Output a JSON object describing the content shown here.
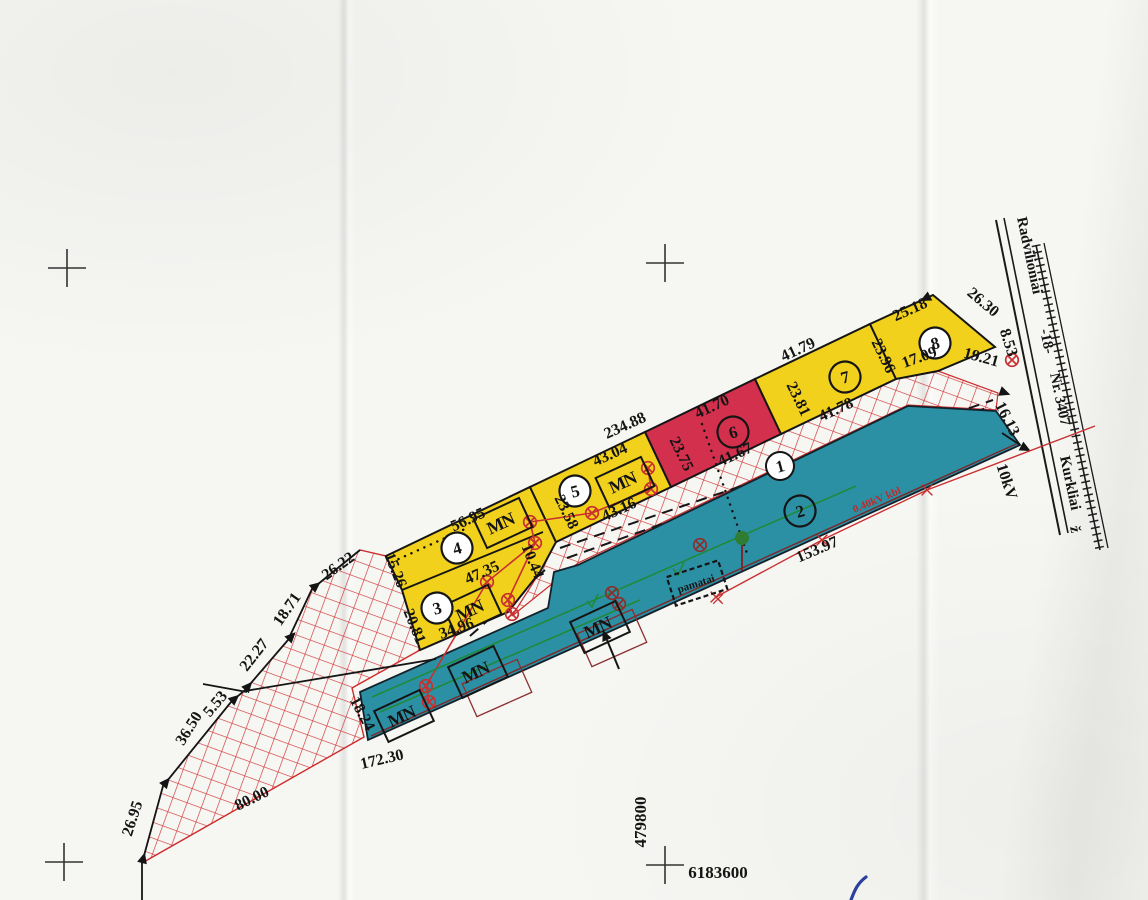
{
  "map": {
    "road": {
      "from": "Radvilioniai",
      "code": "-18-",
      "number": "Nr. 3407",
      "to": "Kurkliai",
      "suffix": "ž"
    },
    "grid": {
      "easting": "479800",
      "northing": "6183600"
    },
    "power": {
      "hv_line": "10kV",
      "lv_cable": "0.40kV kbl"
    },
    "marker_label": "MN",
    "foundation_label": "pamatai",
    "band_total": "234.88",
    "parcels": {
      "p1": {
        "number": "1"
      },
      "p2": {
        "number": "2",
        "south": "153.97",
        "east": "16.13"
      },
      "p3": {
        "number": "3",
        "north": "47.35",
        "south": "34.96",
        "west": "20.81"
      },
      "p4": {
        "number": "4",
        "north": "56.95",
        "west": "15.26",
        "east": "10.44"
      },
      "p5": {
        "number": "5",
        "north": "43.04",
        "west": "23.58",
        "power_span": "43.16"
      },
      "p6": {
        "number": "6",
        "north": "41.70",
        "south": "41.67",
        "west": "23.75",
        "east": "23.81"
      },
      "p7": {
        "number": "7",
        "north": "41.79",
        "south": "41.78",
        "east": "23.96"
      },
      "p8": {
        "number": "8",
        "north": "25.18",
        "south": "17.09",
        "east": "26.30"
      }
    },
    "east_edge": {
      "upper": "8.53",
      "lower": "19.21"
    },
    "west_boundary": {
      "seg1": "26.22",
      "seg2": "18.71",
      "seg3": "22.27",
      "seg4": "5.53",
      "seg5": "36.50",
      "seg6": "26.95",
      "south": "80.00"
    },
    "south_strip": {
      "bottom": "172.30",
      "west": "18.24"
    }
  }
}
